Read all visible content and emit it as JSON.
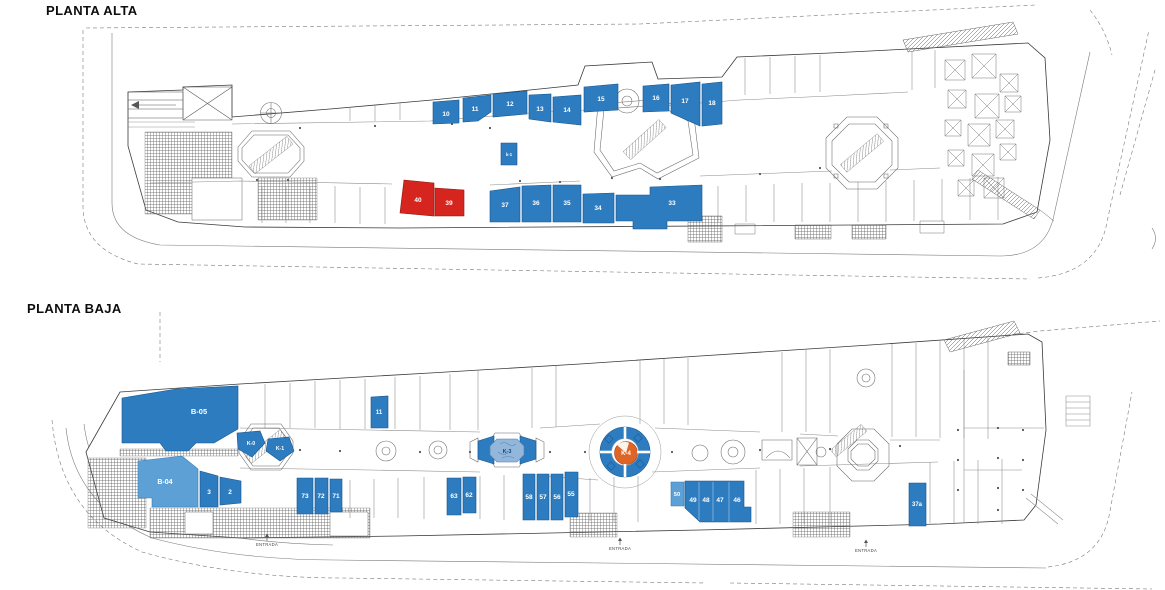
{
  "titles": {
    "alta": "PLANTA ALTA",
    "baja": "PLANTA BAJA"
  },
  "colors": {
    "blue": "#2E7CC0",
    "lightblue": "#5CA0D6",
    "red": "#D6251F",
    "orange": "#DF6527",
    "white": "#FCFCFC",
    "k3fill": "#93B7DA",
    "label": "#FFFFFF",
    "line": "#3A3A3A",
    "entrance_text": "#444444"
  },
  "strokes": {
    "blue": "#17578F",
    "lightblue": "#3A7CB0",
    "red": "#8F1511",
    "orange": "#A4431A",
    "white": "#8899AA",
    "k3fill": "#4F7FAF"
  },
  "planta_alta": {
    "units": [
      {
        "id": "10",
        "label": "10",
        "color": "blue",
        "points": "433,102 459,100 459,123 433,124",
        "lx": 446,
        "ly": 116
      },
      {
        "id": "11",
        "label": "11",
        "color": "blue",
        "points": "463,98 491,95 491,112 478,121 463,122",
        "lx": 475,
        "ly": 111
      },
      {
        "id": "12",
        "label": "12",
        "color": "blue",
        "points": "493,94 527,91 527,114 493,117",
        "lx": 510,
        "ly": 106
      },
      {
        "id": "13",
        "label": "13",
        "color": "blue",
        "points": "529,95 551,94 551,122 529,119",
        "lx": 540,
        "ly": 111
      },
      {
        "id": "14",
        "label": "14",
        "color": "blue",
        "points": "553,97 581,95 581,125 553,122",
        "lx": 567,
        "ly": 112
      },
      {
        "id": "15",
        "label": "15",
        "color": "blue",
        "points": "584,87 618,84 618,110 584,112",
        "lx": 601,
        "ly": 101
      },
      {
        "id": "16",
        "label": "16",
        "color": "blue",
        "points": "643,86 669,84 669,111 643,112",
        "lx": 656,
        "ly": 100
      },
      {
        "id": "17",
        "label": "17",
        "color": "blue",
        "points": "671,85 700,82 700,126 671,113",
        "lx": 685,
        "ly": 103
      },
      {
        "id": "18",
        "label": "18",
        "color": "blue",
        "points": "702,84 722,82 722,124 702,126",
        "lx": 712,
        "ly": 105
      },
      {
        "id": "k-1",
        "label": "k-1",
        "color": "blue",
        "points": "501,143 517,143 517,165 501,165",
        "lx": 509,
        "ly": 156,
        "fs": 4.2
      },
      {
        "id": "40",
        "label": "40",
        "color": "red",
        "points": "404,180 434,183 434,216 400,213",
        "lx": 418,
        "ly": 202
      },
      {
        "id": "39",
        "label": "39",
        "color": "red",
        "points": "435,188 464,190 464,216 435,216",
        "lx": 449,
        "ly": 205
      },
      {
        "id": "37",
        "label": "37",
        "color": "blue",
        "points": "490,191 520,187 520,222 490,222",
        "lx": 505,
        "ly": 207
      },
      {
        "id": "36",
        "label": "36",
        "color": "blue",
        "points": "522,186 551,185 551,222 522,222",
        "lx": 536,
        "ly": 205
      },
      {
        "id": "35",
        "label": "35",
        "color": "blue",
        "points": "553,185 581,185 581,222 553,222",
        "lx": 567,
        "ly": 205
      },
      {
        "id": "34",
        "label": "34",
        "color": "blue",
        "points": "583,194 614,193 614,223 583,223",
        "lx": 598,
        "ly": 210
      },
      {
        "id": "33",
        "label": "33",
        "color": "blue",
        "points": "616,195 650,195 650,187 702,185 702,221 667,221 667,229 633,229 633,221 616,221",
        "lx": 672,
        "ly": 205
      }
    ]
  },
  "planta_baja": {
    "units": [
      {
        "id": "B-05",
        "label": "B-05",
        "color": "blue",
        "points": "122,398 176,389 238,386 238,429 214,443 196,443 188,451 166,451 160,443 122,443",
        "lx": 199,
        "ly": 414,
        "fs": 7.5
      },
      {
        "id": "11",
        "label": "11",
        "color": "blue",
        "points": "371,397 388,396 388,428 371,428",
        "lx": 379,
        "ly": 414,
        "fs": 6
      },
      {
        "id": "K-0",
        "label": "K-0",
        "color": "blue",
        "points": "237,433 260,431 265,443 252,457 238,449",
        "lx": 251,
        "ly": 445,
        "fs": 5.2
      },
      {
        "id": "K-1",
        "label": "K-1",
        "color": "blue",
        "points": "268,439 289,437 294,451 280,461 266,451",
        "lx": 280,
        "ly": 450,
        "fs": 5.2
      },
      {
        "id": "B-04",
        "label": "B-04",
        "color": "lightblue",
        "points": "138,461 182,456 198,469 198,507 152,507 152,498 138,498",
        "lx": 165,
        "ly": 484,
        "fs": 7
      },
      {
        "id": "3",
        "label": "3",
        "color": "blue",
        "points": "200,471 218,476 218,507 200,507",
        "lx": 209,
        "ly": 494
      },
      {
        "id": "2",
        "label": "2",
        "color": "blue",
        "points": "220,477 241,481 241,503 220,505",
        "lx": 230,
        "ly": 494
      },
      {
        "id": "73",
        "label": "73",
        "color": "blue",
        "points": "297,478 313,478 313,514 297,514",
        "lx": 305,
        "ly": 498
      },
      {
        "id": "72",
        "label": "72",
        "color": "blue",
        "points": "315,478 328,478 328,514 315,514",
        "lx": 321,
        "ly": 498
      },
      {
        "id": "71",
        "label": "71",
        "color": "blue",
        "points": "330,479 342,479 342,512 330,512",
        "lx": 336,
        "ly": 498
      },
      {
        "id": "63",
        "label": "63",
        "color": "blue",
        "points": "447,478 461,478 461,515 447,515",
        "lx": 454,
        "ly": 498
      },
      {
        "id": "62",
        "label": "62",
        "color": "blue",
        "points": "463,477 476,477 476,513 463,513",
        "lx": 469,
        "ly": 497
      },
      {
        "id": "58",
        "label": "58",
        "color": "blue",
        "points": "523,474 535,474 535,520 523,520",
        "lx": 529,
        "ly": 499
      },
      {
        "id": "57",
        "label": "57",
        "color": "blue",
        "points": "537,474 549,474 549,520 537,520",
        "lx": 543,
        "ly": 499
      },
      {
        "id": "56",
        "label": "56",
        "color": "blue",
        "points": "551,474 563,474 563,520 551,520",
        "lx": 557,
        "ly": 499
      },
      {
        "id": "55",
        "label": "55",
        "color": "blue",
        "points": "565,472 578,472 578,517 565,517",
        "lx": 571,
        "ly": 496
      },
      {
        "id": "50",
        "label": "50",
        "color": "lightblue",
        "points": "671,482 684,482 684,506 671,506",
        "lx": 677,
        "ly": 496,
        "fs": 5.8
      },
      {
        "id": "46-49",
        "color": "blue",
        "points": "685,481 744,481 744,507 751,507 751,522 700,522 685,508",
        "labels": [
          {
            "text": "49",
            "x": 693,
            "y": 502
          },
          {
            "text": "48",
            "x": 706,
            "y": 502
          },
          {
            "text": "47",
            "x": 720,
            "y": 502
          },
          {
            "text": "46",
            "x": 737,
            "y": 502
          }
        ]
      },
      {
        "id": "K-3-wing-left",
        "color": "blue",
        "points": "478,441 494,436 494,464 478,459"
      },
      {
        "id": "K-3-wing-right",
        "color": "blue",
        "points": "520,436 536,441 536,459 520,464"
      },
      {
        "id": "K-3",
        "label": "K-3",
        "color": "k3fill",
        "points": "497,439 517,439 524,446 524,455 517,462 497,462 490,455 490,446",
        "lx": 507,
        "ly": 453,
        "fs": 5.5,
        "label_color": "#17457F"
      },
      {
        "id": "K-4-ring",
        "type": "circle",
        "cx": 625,
        "cy": 452,
        "r": 25,
        "color": "blue"
      },
      {
        "id": "K-4-white",
        "type": "circle",
        "cx": 625,
        "cy": 452,
        "r": 13.5,
        "color": "white"
      },
      {
        "id": "K-4",
        "type": "circle",
        "cx": 626,
        "cy": 453,
        "r": 11.5,
        "color": "orange",
        "label": "K-4",
        "lx": 626,
        "ly": 455,
        "fs": 6,
        "label_color": "#FFFFFF"
      },
      {
        "id": "37a",
        "label": "37a",
        "color": "blue",
        "points": "909,483 926,483 926,526 909,526",
        "lx": 917,
        "ly": 506,
        "fs": 6
      }
    ],
    "entrances": [
      {
        "label": "ENTRADA",
        "x": 267,
        "y": 546
      },
      {
        "label": "ENTRADA",
        "x": 620,
        "y": 550
      },
      {
        "label": "ENTRADA",
        "x": 866,
        "y": 552
      }
    ]
  }
}
